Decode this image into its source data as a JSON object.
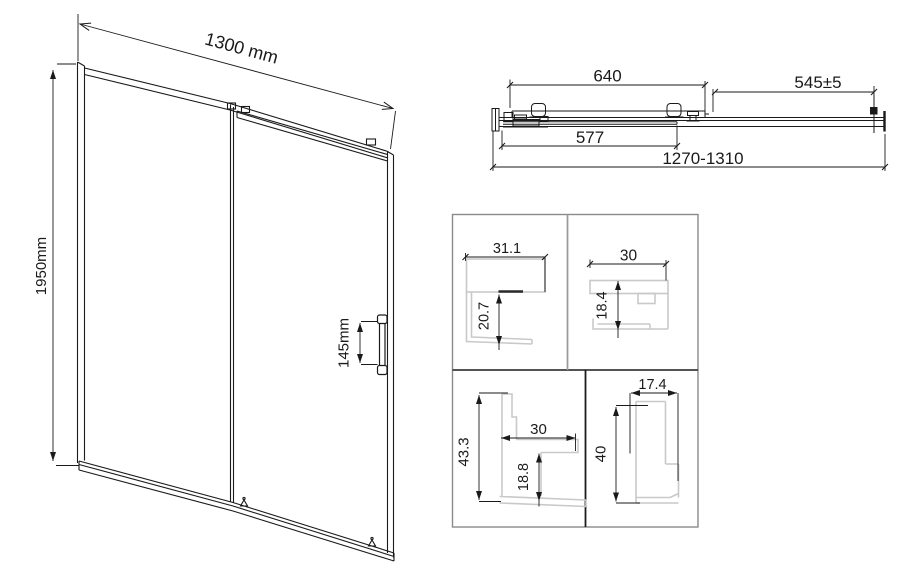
{
  "drawing_title": "Sliding shower door technical drawing",
  "front_view": {
    "width": "1300 mm",
    "height": "1950mm",
    "handle_height": "145mm"
  },
  "top_view": {
    "panel_width": "640",
    "opening_width": "545±5",
    "glass_width": "577",
    "adjustment_range": "1270-1310"
  },
  "profiles": {
    "top_left": {
      "width": "31.1",
      "depth": "20.7"
    },
    "top_right": {
      "width": "30",
      "depth": "18.4"
    },
    "bottom_left": {
      "height": "43.3",
      "width": "30",
      "depth": "18.8"
    },
    "bottom_right": {
      "width": "17.4",
      "height": "40"
    }
  },
  "colors": {
    "line": "#1a1a1a",
    "profile_gray": "#c9c9c9",
    "grid_border": "#8a8a8a"
  }
}
